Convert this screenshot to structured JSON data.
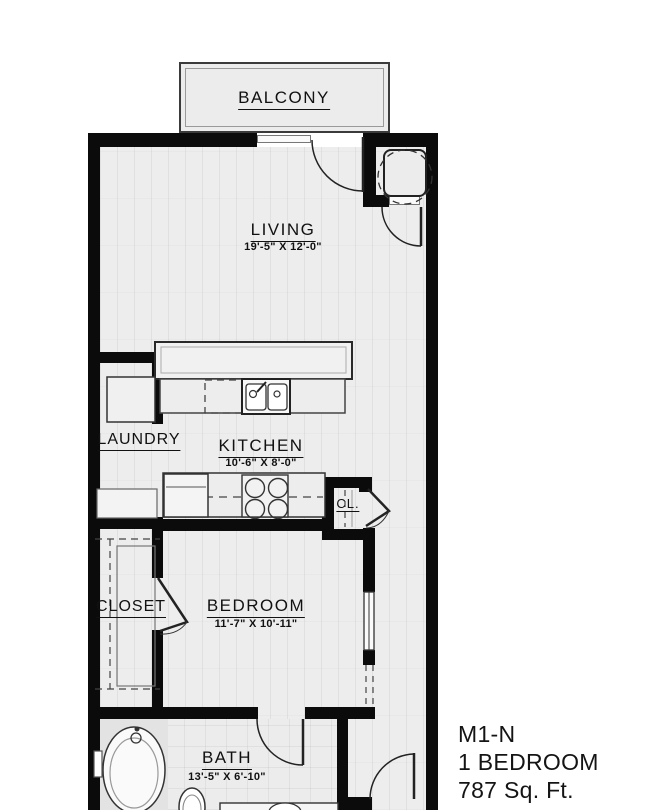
{
  "plan_info": {
    "model": "M1-N",
    "unit_type": "1 BEDROOM",
    "area": "787 Sq. Ft."
  },
  "rooms": {
    "balcony": {
      "label": "BALCONY"
    },
    "living": {
      "label": "LIVING",
      "dimensions": "19'-5\" X 12'-0\""
    },
    "laundry": {
      "label": "LAUNDRY"
    },
    "kitchen": {
      "label": "KITCHEN",
      "dimensions": "10'-6\" X 8'-0\""
    },
    "hall_closet": {
      "label": "CL."
    },
    "bedroom_closet": {
      "label": "CLOSET"
    },
    "bedroom": {
      "label": "BEDROOM",
      "dimensions": "11'-7\" X 10'-11\""
    },
    "bath": {
      "label": "BATH",
      "dimensions": "13'-5\" X 6'-10\""
    }
  },
  "colors": {
    "wall": "#0b0b0b",
    "floor": "#ededed",
    "balcony_border": "#3b3b3b",
    "text": "#111111"
  }
}
